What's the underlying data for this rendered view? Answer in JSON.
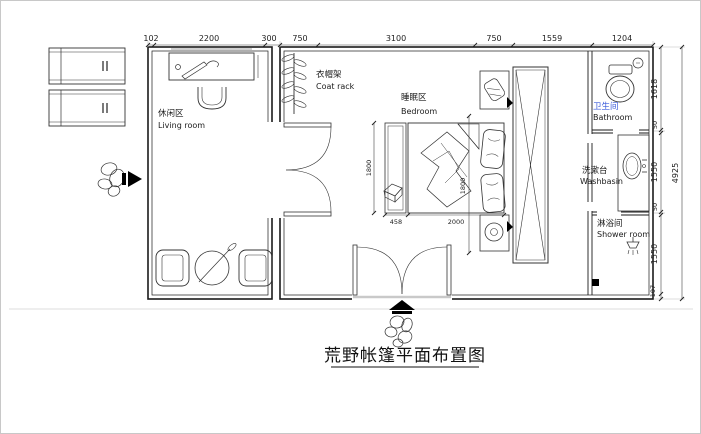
{
  "title": {
    "text": "荒野帐篷平面布置图"
  },
  "rooms": {
    "living": {
      "zh": "休闲区",
      "en": "Living room"
    },
    "coat_rack": {
      "zh": "衣帽架",
      "en": "Coat rack"
    },
    "bedroom": {
      "zh": "睡眠区",
      "en": "Bedroom"
    },
    "bathroom": {
      "zh": "卫生间",
      "en": "Bathroom"
    },
    "washbasin": {
      "zh": "洗漱台",
      "en": "Washbasin"
    },
    "shower": {
      "zh": "淋浴间",
      "en": "Shower room"
    }
  },
  "dimensions": {
    "top": [
      "102",
      "2200",
      "300",
      "750",
      "3100",
      "750",
      "1559",
      "1204"
    ],
    "right": [
      "1618",
      "50",
      "1550",
      "50",
      "1550",
      "107"
    ],
    "right_total": "4925",
    "bed": {
      "foot_stool": "458",
      "length": "2000",
      "width": "1800",
      "width_b": "1800"
    }
  },
  "colors": {
    "line": "#1a1a1a",
    "bathroom_label": "#3b5bdb"
  }
}
